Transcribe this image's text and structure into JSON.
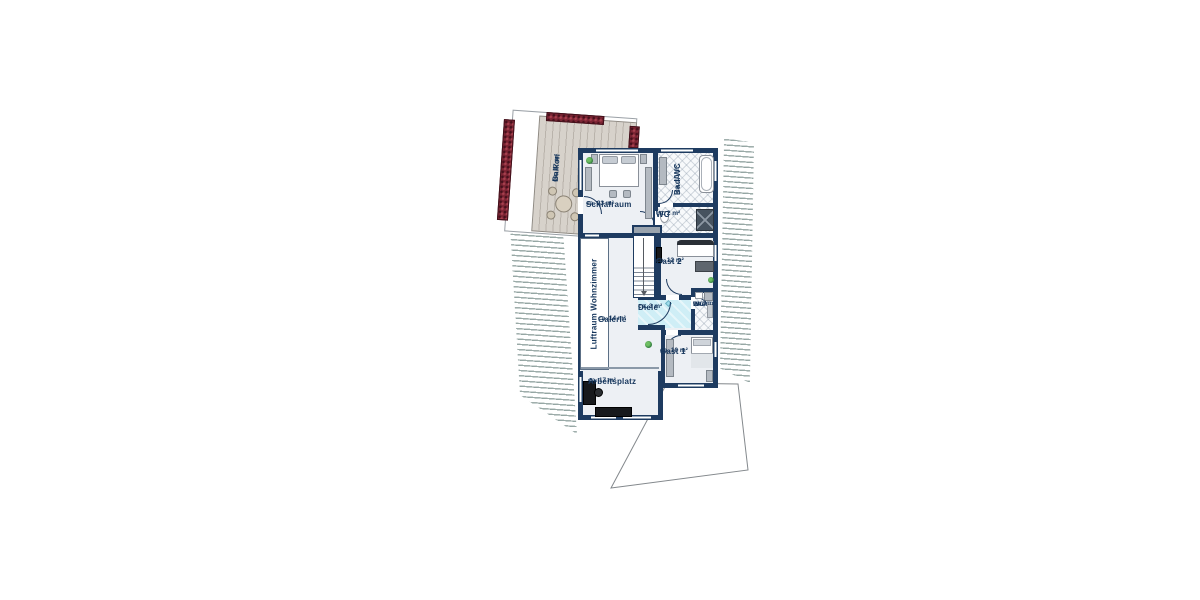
{
  "title": "Obergeschoss Grundriss",
  "rooms": {
    "balkon": {
      "name": "Balkon",
      "area": "ca. 17 m²"
    },
    "schlafraum": {
      "name": "Schlafraum",
      "area": "ca. 23 m²"
    },
    "bad": {
      "name": "Bad/WC",
      "area": "ca. 10 m²"
    },
    "wc": {
      "name": "WC",
      "area": "ca. 2 m²"
    },
    "gast2": {
      "name": "Gast 2",
      "area": "ca. 12 m²"
    },
    "diele": {
      "name": "Diele",
      "area": "ca. 3 m²"
    },
    "badwc3": {
      "line1": "Bad/",
      "line2": "WC",
      "area": "ca. 3 m²"
    },
    "gast1": {
      "name": "Gast 1",
      "area": "ca. 10 m²"
    },
    "galerie": {
      "name": "Galerie",
      "area": "ca. 14 m²"
    },
    "luftraum": {
      "name": "Luftraum Wohnzimmer"
    },
    "arbeitsplatz": {
      "name": "Arbeitsplatz",
      "area": "ca. 17 m²"
    }
  },
  "colors": {
    "wall": "#1e3b60",
    "label_text": "#16365c",
    "room_floor": "#edf0f4",
    "hall_floor": "#cfeef6",
    "deck": "#cdc7bf",
    "flower_box": "#7b2433",
    "roof_stripe": "#8ca09d",
    "furniture_grey": "#b4bac1",
    "furniture_dark": "#17191c",
    "plant_green": "#2f7a3c"
  }
}
